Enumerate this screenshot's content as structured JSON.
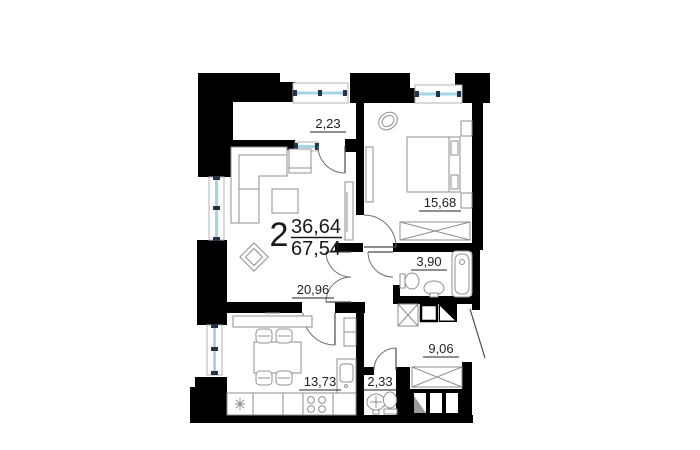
{
  "plan": {
    "apartment": {
      "rooms_count": "2",
      "living_area": "36,64",
      "total_area": "67,54"
    },
    "rooms": [
      {
        "id": "loggia",
        "area": "2,23"
      },
      {
        "id": "bedroom",
        "area": "15,68"
      },
      {
        "id": "bathroom",
        "area": "3,90"
      },
      {
        "id": "living-room",
        "area": "20,96"
      },
      {
        "id": "hallway",
        "area": "9,06"
      },
      {
        "id": "kitchen",
        "area": "13,73"
      },
      {
        "id": "toilet",
        "area": "2,33"
      }
    ],
    "colors": {
      "wall": "#000000",
      "window_glass": "#a3d4e8",
      "window_tick": "#24324a",
      "furniture_line": "#8f8f8f",
      "label_text": "#222222"
    }
  }
}
